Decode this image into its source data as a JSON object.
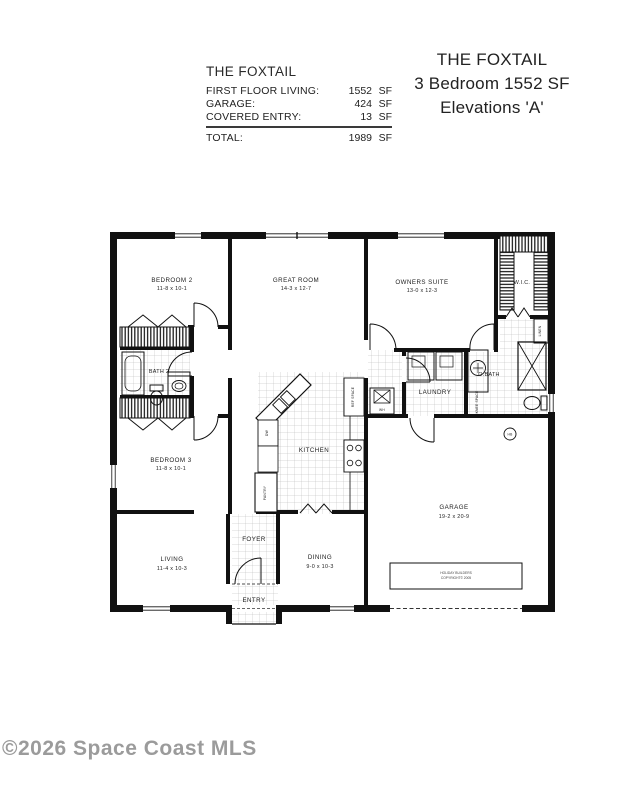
{
  "header": {
    "summary_table": {
      "title": "THE FOXTAIL",
      "rows": [
        {
          "label": "FIRST FLOOR LIVING:",
          "value": "1552",
          "unit": "SF"
        },
        {
          "label": "GARAGE:",
          "value": "424",
          "unit": "SF"
        },
        {
          "label": "COVERED ENTRY:",
          "value": "13",
          "unit": "SF"
        }
      ],
      "total_row": {
        "label": "TOTAL:",
        "value": "1989",
        "unit": "SF"
      }
    },
    "title_block": {
      "line1": "THE FOXTAIL",
      "line2": "3 Bedroom 1552 SF",
      "line3": "Elevations 'A'"
    }
  },
  "floor_plan": {
    "rooms": {
      "bedroom2": {
        "name": "BEDROOM 2",
        "dims": "11-8 x 10-1"
      },
      "great_room": {
        "name": "GREAT ROOM",
        "dims": "14-3 x 12-7"
      },
      "owners_suite": {
        "name": "OWNERS SUITE",
        "dims": "13-0 x 12-3"
      },
      "wic": {
        "name": "W.I.C."
      },
      "bath2": {
        "name": "BATH 2"
      },
      "laundry": {
        "name": "LAUNDRY"
      },
      "obath": {
        "name": "O.BATH"
      },
      "kitchen": {
        "name": "KITCHEN"
      },
      "bedroom3": {
        "name": "BEDROOM 3",
        "dims": "11-8 x 10-1"
      },
      "living": {
        "name": "LIVING",
        "dims": "11-4 x 10-3"
      },
      "foyer": {
        "name": "FOYER"
      },
      "dining": {
        "name": "DINING",
        "dims": "9-0 x 10-3"
      },
      "entry": {
        "name": "ENTRY"
      },
      "garage": {
        "name": "GARAGE",
        "dims": "19-2 x 20-9"
      }
    },
    "annotations": {
      "ref_space": "REF SPACE",
      "dw": "DW",
      "pantry": "PANTRY",
      "wh": "WH",
      "knee_space": "KNEE SPACE",
      "linen": "LINEN",
      "hb": "HB",
      "builder_stamp_line1": "HOLIDAY BUILDERS",
      "builder_stamp_line2": "COPYRIGHT© 2005"
    },
    "colors": {
      "wall": "#111111",
      "tile_line": "#9a9a9a"
    }
  },
  "watermark": {
    "text": "©2026 Space Coast MLS",
    "color": "#9b9b9b"
  }
}
